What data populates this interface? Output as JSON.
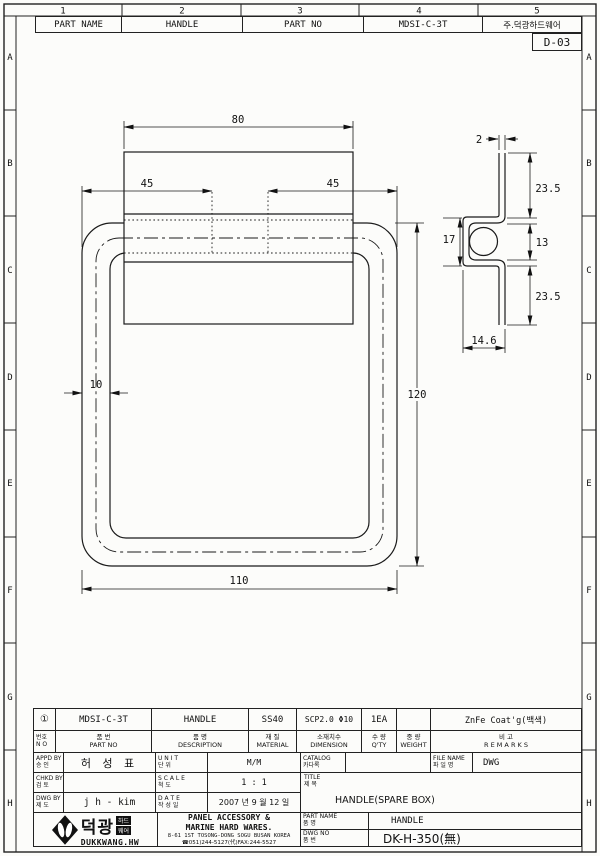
{
  "sheet": {
    "zone_cols": [
      "1",
      "2",
      "3",
      "4",
      "5"
    ],
    "zone_rows": [
      "A",
      "B",
      "C",
      "D",
      "E",
      "F",
      "G",
      "H"
    ],
    "sheet_no": "D-03"
  },
  "header": {
    "part_name_label": "PART NAME",
    "part_name_value": "HANDLE",
    "part_no_label": "PART NO",
    "part_no_value": "MDSI-C-3T",
    "company": "주.덕광하드웨어"
  },
  "front_view": {
    "dim_top_width": "80",
    "dim_left_offset": "45",
    "dim_right_offset": "45",
    "dim_height": "120",
    "dim_bottom_width": "110",
    "dim_tube_width": "10"
  },
  "section_view": {
    "dim_thickness": "2",
    "dim_top_leg": "23.5",
    "dim_pocket_height": "17",
    "dim_inner_gap": "13",
    "dim_bottom_leg": "23.5",
    "dim_base_width": "14.6"
  },
  "parts_list": {
    "row": {
      "no": "①",
      "part_no": "MDSI-C-3T",
      "description": "HANDLE",
      "material": "SS40",
      "dimension": "SCP2.0 Φ10",
      "qty": "1EA",
      "weight": "",
      "remarks": "ZnFe Coat'g(백색)"
    },
    "headers": {
      "no_ko": "번호",
      "no_en": "N O",
      "part_no_ko": "품    번",
      "part_no_en": "PART    NO",
      "desc_ko": "품    명",
      "desc_en": "DESCRIPTION",
      "material_ko": "재 질",
      "material_en": "MATERIAL",
      "dimension_ko": "소재치수",
      "dimension_en": "DIMENSION",
      "qty_ko": "수 량",
      "qty_en": "Q'TY",
      "weight_ko": "중 량",
      "weight_en": "WEIGHT",
      "remarks_ko": "비    고",
      "remarks_en": "R E M A R K S"
    }
  },
  "title_block": {
    "appd_en": "APPD BY",
    "appd_ko": "승  인",
    "appd_value": "허 성 표",
    "chkd_en": "CHKD BY",
    "chkd_ko": "검  토",
    "chkd_value": "",
    "dwgby_en": "DWG BY",
    "dwgby_ko": "제  도",
    "dwgby_value": "j h - kim",
    "unit_en": "U N I T",
    "unit_ko": "단  위",
    "unit_value": "M/M",
    "scale_en": "S C A L E",
    "scale_ko": "척  도",
    "scale_value": "1 : 1",
    "date_en": "D A T E",
    "date_ko": "작 성 일",
    "date_value": "2007 년 9 월 12 일",
    "catalog_en": "CATALOG",
    "catalog_ko": "카다록",
    "catalog_value": "",
    "file_en": "FILE NAME",
    "file_ko": "파 일 명",
    "file_value": "DWG",
    "title_en": "TITLE",
    "title_ko": "제 목",
    "title_value": "HANDLE(SPARE BOX)"
  },
  "maker": {
    "logo_ko": "덕광",
    "logo_sub1": "하드",
    "logo_sub2": "웨어",
    "logo_en": "DUKKWANG.HW",
    "line1": "PANEL ACCESSORY &",
    "line2": "MARINE HARD WARES.",
    "line3": "8-61 1ST TOSONG-DONG SOGU BUSAN KOREA",
    "line4": "☎051)244-5127(代)FAX:244-5527",
    "part_name_en": "PART NAME",
    "part_name_ko": "품  명",
    "part_name_value": "HANDLE",
    "dwg_no_en": "DWG NO",
    "dwg_no_ko": "품  번",
    "dwg_no_value": "DK-H-350(無)"
  }
}
